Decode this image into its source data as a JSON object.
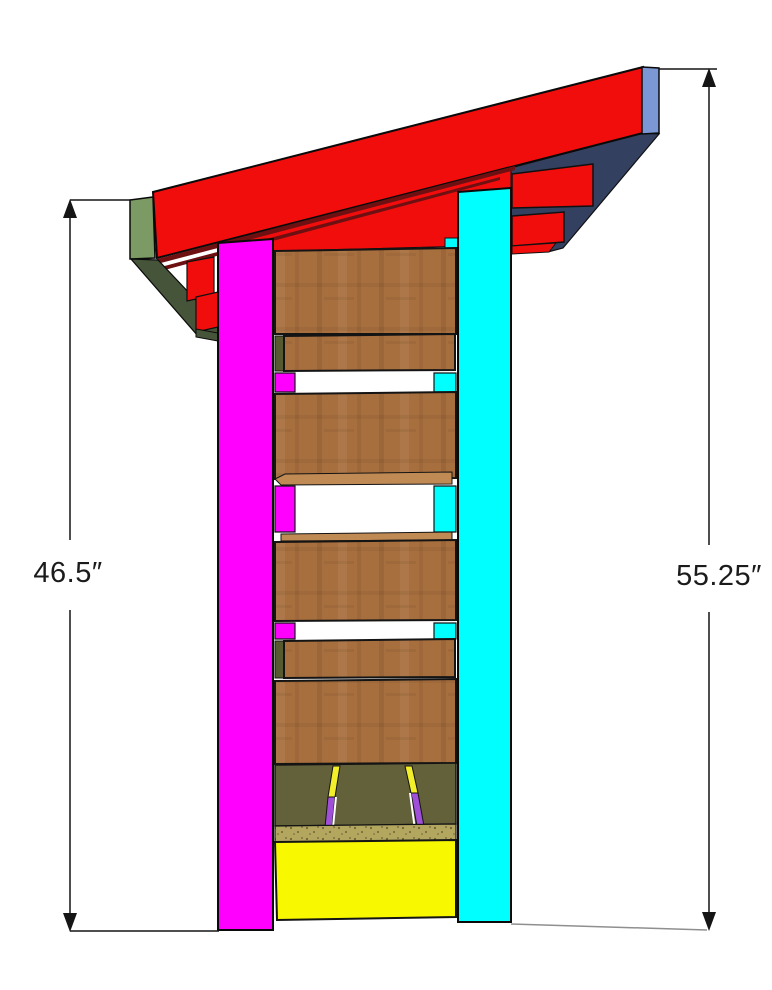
{
  "diagram": {
    "dimensions": {
      "left": {
        "label": "46.5″"
      },
      "right": {
        "label": "55.25″"
      }
    },
    "colors": {
      "red": "#f20d0d",
      "dark_red": "#6e1012",
      "green": "#7c9a63",
      "dark_green": "#46543a",
      "navy": "#344060",
      "cap_blue": "#7b97d4",
      "magenta": "#ff00ff",
      "cyan": "#00ffff",
      "slat_brown": "#a86f3e",
      "slat_top_face": "#c08a55",
      "wedge_olive": "#565a2e",
      "floor_olive": "#63613a",
      "speckle_tan": "#b3a75f",
      "speckle_dot": "#6d6337",
      "panel_yellow": "#f8f800",
      "stripe_yellow": "#f2ef2a",
      "stripe_purple": "#a04fd8",
      "stripe_white": "#ffffff",
      "ground_gray": "#8f8f8f",
      "dim_line": "#151515",
      "text": "#1b1b1b"
    }
  }
}
